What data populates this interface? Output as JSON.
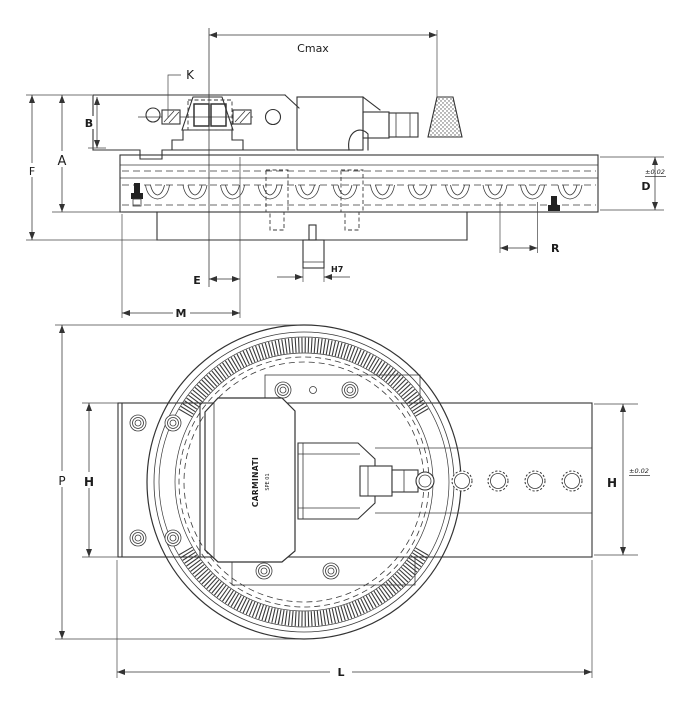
{
  "drawing": {
    "labels": {
      "cmax": "Cmax",
      "k": "K",
      "b": "B",
      "a": "A",
      "f": "F",
      "d": "D",
      "d_tolerance": "±0.02",
      "e": "E",
      "m": "M",
      "h7": "H7",
      "r": "R",
      "p": "P",
      "h_left": "H",
      "h_right": "H",
      "h_tolerance": "±0.02",
      "l": "L",
      "brand_line1": "CARMINATI",
      "brand_line2": "SPE 01"
    }
  }
}
